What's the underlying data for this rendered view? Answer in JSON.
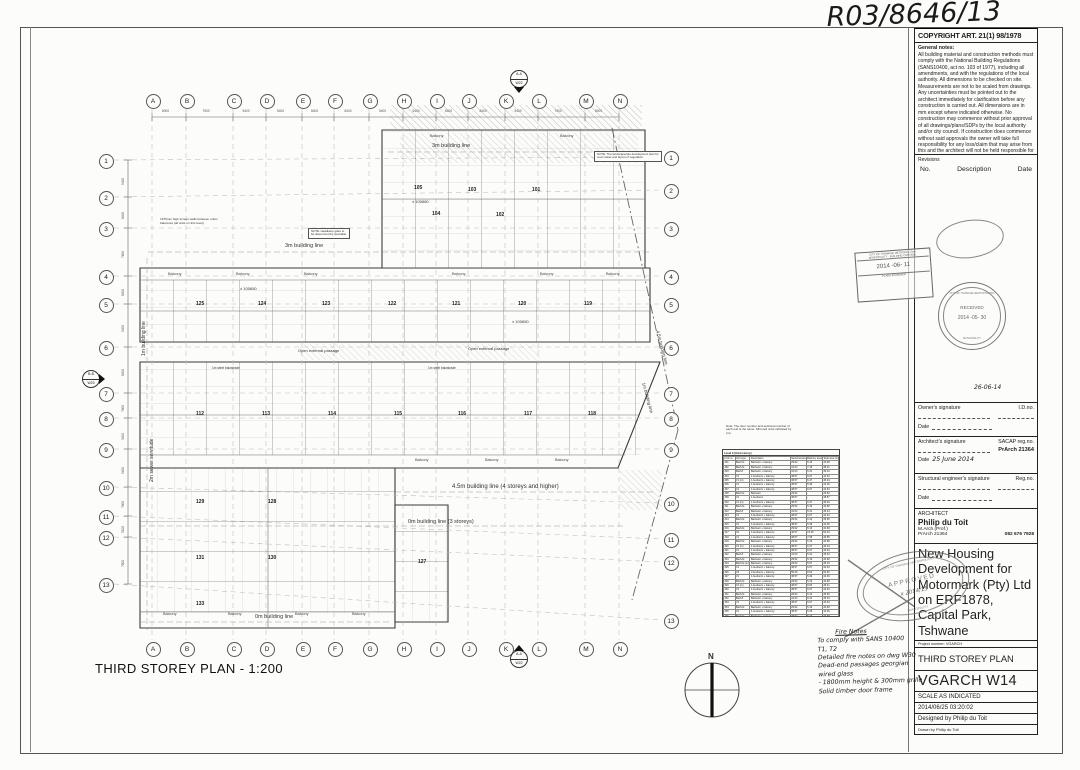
{
  "annotations": {
    "drawing_number": "R03/8646/13",
    "sig_date_main": "26-06-14",
    "approved_word": "APPROVED",
    "approved_note": "x 2014/15"
  },
  "title_block": {
    "copyright": "COPYRIGHT ART. 21(1) 98/1978",
    "general_notes_title": "General notes:",
    "general_notes": "All building material and construction methods must comply with the National Building Regulations (SANS10400, act no. 103 of 1977), including all amendments, and with the regulations of the local authority. All dimensions to be checked on site. Measurements are not to be scaled from drawings. Any uncertainties must be pointed out to the architect immediately for clarification before any construction is carried out. All dimensions are in mm except where indicated otherwise. No construction may commence without prior approval of all drawings/plans/SDPs by the local authority and/or city council. If construction does commence without said approvals the owner will take full responsibility for any loss/claim that may arise from this and the architect will not be held responsible for any loss/claim.",
    "revisions_label": "Revisions",
    "rev_no": "No.",
    "rev_desc": "Description",
    "rev_date": "Date",
    "owner_label": "Owner's signature",
    "owner_id_label": "I.D.no.",
    "date_label": "Date",
    "arch_sig_label": "Architect's signature",
    "arch_reg_label": "SACAP reg.no.",
    "arch_reg_no": "PrArch 21364",
    "arch_sig_date": "25 June 2014",
    "eng_label": "Structural engineer's signature",
    "eng_reg_label": "Reg.no.",
    "architect_heading": "ARCHITECT",
    "architect_name": "Philip du Toit",
    "architect_qual": "M.Arch.(Prof.)",
    "architect_reg": "PrArch 21364",
    "architect_phone": "082 676 7928",
    "project_title": "New Housing Development for Motormark (Pty) Ltd on ERF1878, Capital Park, Tshwane",
    "project_number": "Project number:  VGARCH",
    "sheet_title": "THIRD STOREY PLAN",
    "drawing_code": "VGARCH W14",
    "scale": "SCALE AS INDICATED",
    "datetime": "2014/06/25 03:20:02",
    "designed_by": "Designed by Philip du Toit",
    "drawn_by": "Drawn by Philip du Toit"
  },
  "stamps": {
    "received_word": "RECEIVED",
    "received_date": "2014 -05- 30",
    "received_ring_top": "CITY OF TSHWANE METROPOLITAN",
    "received_ring_bottom": "MUNICIPALITY",
    "rect_line1": "CITY OF TSHWANE METROPOLITAN",
    "rect_line2": "MUNICIPALITY · BUILDING CONTROL",
    "rect_date": "2014 -06- 11",
    "rect_line3": "PLANS EXAMINER",
    "approved_ring_top": "CITY OF TSHWANE METROPOLITAN",
    "approved_ring_bottom": "MUNICIPALITY"
  },
  "plan": {
    "title": "THIRD STOREY PLAN - 1:200",
    "north_label": "N",
    "balcony_label": "Balcony",
    "grid_top_y": 100,
    "grid_bottom_y": 648,
    "grid_letters": [
      {
        "l": "A",
        "x": 152
      },
      {
        "l": "B",
        "x": 186
      },
      {
        "l": "C",
        "x": 233
      },
      {
        "l": "D",
        "x": 266
      },
      {
        "l": "E",
        "x": 302
      },
      {
        "l": "F",
        "x": 334
      },
      {
        "l": "G",
        "x": 369
      },
      {
        "l": "H",
        "x": 403
      },
      {
        "l": "I",
        "x": 436
      },
      {
        "l": "J",
        "x": 468
      },
      {
        "l": "K",
        "x": 505
      },
      {
        "l": "L",
        "x": 538
      },
      {
        "l": "M",
        "x": 585
      },
      {
        "l": "N",
        "x": 619
      }
    ],
    "top_dims": [
      "8000",
      "7500",
      "5400",
      "5400",
      "8400",
      "8400",
      "5400",
      "5400",
      "8400",
      "8400",
      "5400",
      "7000",
      "8400"
    ],
    "rows_left_x": 105,
    "rows_right_x": 670,
    "grid_rows": [
      {
        "n": "1",
        "y": 160,
        "yr": 157
      },
      {
        "n": "2",
        "y": 197,
        "yr": 190
      },
      {
        "n": "3",
        "y": 228,
        "yr": 228
      },
      {
        "n": "4",
        "y": 276,
        "yr": 276
      },
      {
        "n": "5",
        "y": 304,
        "yr": 304
      },
      {
        "n": "6",
        "y": 347,
        "yr": 347
      },
      {
        "n": "7",
        "y": 393,
        "yr": 393
      },
      {
        "n": "8",
        "y": 418,
        "yr": 418
      },
      {
        "n": "9",
        "y": 449,
        "yr": 449
      },
      {
        "n": "10",
        "y": 487,
        "yr": 503
      },
      {
        "n": "11",
        "y": 516,
        "yr": 539
      },
      {
        "n": "12",
        "y": 537,
        "yr": 562
      },
      {
        "n": "13",
        "y": 584,
        "yr": 620
      }
    ],
    "left_dims": [
      "9400",
      "8400",
      "7600",
      "8400",
      "5400",
      "8400",
      "7600",
      "3400",
      "9400",
      "7600",
      "5100",
      "7600"
    ],
    "section_top": {
      "a": "A-A",
      "b": "W22"
    },
    "section_bottom": {
      "a": "A-A",
      "b": "W22"
    },
    "section_left": {
      "a": "B-B",
      "b": "W23"
    },
    "labels": [
      {
        "t": "3m building line",
        "x": 285,
        "y": 243,
        "s": 5.5
      },
      {
        "t": "3m building line",
        "x": 432,
        "y": 143,
        "s": 5.5
      },
      {
        "t": "1m building line",
        "x": 142,
        "y": 356,
        "s": 5,
        "r": -90
      },
      {
        "t": "2m sewer servitude",
        "x": 150,
        "y": 482,
        "s": 5,
        "r": -90
      },
      {
        "t": "4.5m building line (4 storeys and higher)",
        "x": 452,
        "y": 484,
        "s": 6
      },
      {
        "t": "0m building line (3 storeys)",
        "x": 408,
        "y": 519,
        "s": 5.5
      },
      {
        "t": "0m building line",
        "x": 255,
        "y": 614,
        "s": 5.5
      },
      {
        "t": "1m building line",
        "x": 646,
        "y": 382,
        "s": 4.5,
        "r": 75
      },
      {
        "t": "4.5m building line",
        "x": 660,
        "y": 330,
        "s": 4.5,
        "r": 75
      },
      {
        "t": "Open external passage",
        "x": 298,
        "y": 349,
        "s": 4
      },
      {
        "t": "Open external passage",
        "x": 468,
        "y": 347,
        "s": 4
      },
      {
        "t": "1m steel balustrade",
        "x": 212,
        "y": 367,
        "s": 3.2
      },
      {
        "t": "1m steel balustrade",
        "x": 428,
        "y": 367,
        "s": 3.2
      },
      {
        "t": "± 100650",
        "x": 240,
        "y": 287,
        "s": 4
      },
      {
        "t": "± 100650",
        "x": 512,
        "y": 320,
        "s": 4
      },
      {
        "t": "± 100660",
        "x": 412,
        "y": 200,
        "s": 4
      },
      {
        "t": "1675mm high screen walls between units/ balconies (all units on this level)",
        "x": 160,
        "y": 218,
        "s": 3.1,
        "w": 58,
        "wrap": 1
      },
      {
        "t": "NOTE: The landscape/site development plan for court areas and layout of vegetation.",
        "x": 594,
        "y": 151,
        "s": 2.9,
        "w": 62,
        "wrap": 1,
        "bx": 1
      },
      {
        "t": "NOTE: Headlamp glare to be determined by specialist.",
        "x": 308,
        "y": 228,
        "s": 2.9,
        "w": 36,
        "wrap": 1,
        "bx": 1
      },
      {
        "t": "Note: The door number and sectional number of each unit is the same. Mirrored units indicated by (m).",
        "x": 726,
        "y": 425,
        "s": 3,
        "w": 66,
        "wrap": 1
      }
    ],
    "balconies": [
      [
        168,
        272
      ],
      [
        236,
        272
      ],
      [
        304,
        272
      ],
      [
        452,
        272
      ],
      [
        540,
        272
      ],
      [
        606,
        272
      ],
      [
        430,
        134
      ],
      [
        560,
        134
      ],
      [
        415,
        458
      ],
      [
        485,
        458
      ],
      [
        555,
        458
      ],
      [
        163,
        612
      ],
      [
        228,
        612
      ],
      [
        295,
        612
      ],
      [
        352,
        612
      ]
    ],
    "unit_numbers": [
      [
        "105",
        414,
        186
      ],
      [
        "104",
        432,
        212
      ],
      [
        "103",
        468,
        188
      ],
      [
        "102",
        496,
        213
      ],
      [
        "101",
        532,
        188
      ],
      [
        "125",
        196,
        302
      ],
      [
        "124",
        258,
        302
      ],
      [
        "123",
        322,
        302
      ],
      [
        "122",
        388,
        302
      ],
      [
        "121",
        452,
        302
      ],
      [
        "120",
        518,
        302
      ],
      [
        "119",
        584,
        302
      ],
      [
        "112",
        196,
        412
      ],
      [
        "113",
        262,
        412
      ],
      [
        "114",
        328,
        412
      ],
      [
        "115",
        394,
        412
      ],
      [
        "116",
        458,
        412
      ],
      [
        "117",
        524,
        412
      ],
      [
        "118",
        588,
        412
      ],
      [
        "129",
        196,
        500
      ],
      [
        "128",
        268,
        500
      ],
      [
        "131",
        196,
        556
      ],
      [
        "130",
        268,
        556
      ],
      [
        "133",
        196,
        602
      ],
      [
        "127",
        418,
        560
      ]
    ]
  },
  "schedule": {
    "title": "Level 3 (third storey)",
    "headers": [
      "Unit no.",
      "Unit type",
      "Description",
      "Sectional area (m²)",
      "Balcony area (m²)",
      "Total area (m²)"
    ],
    "rows": [
      [
        "301",
        "Bach/st",
        "Bachelor + balcony",
        "29.52",
        "5.16",
        "34.68"
      ],
      [
        "302",
        "Bach/st",
        "Bachelor + balcony",
        "31.03",
        "7.18",
        "38.21"
      ],
      [
        "303",
        "Bach/f",
        "Bachelor + balcony",
        "31.03",
        "5.31",
        "36.34"
      ],
      [
        "304",
        "V1",
        "1-bedroom + balcony",
        "38.57",
        "6.07",
        "44.64"
      ],
      [
        "305",
        "V1 (m)",
        "1-bedroom + balcony",
        "38.57",
        "6.47",
        "45.04"
      ],
      [
        "306",
        "V1",
        "1-bedroom + balcony",
        "38.57",
        "5.49",
        "44.06"
      ],
      [
        "307",
        "V1",
        "1-bedroom + balcony",
        "38.57",
        "6.07",
        "44.64"
      ],
      [
        "308",
        "Bach/st",
        "Bachelor",
        "29.52",
        "-",
        "29.52"
      ],
      [
        "309",
        "V1",
        "1-bedroom",
        "38.57",
        "-",
        "38.57"
      ],
      [
        "310",
        "V1 (m)",
        "1-bedroom + balcony",
        "38.57",
        "6.47",
        "45.04"
      ],
      [
        "311",
        "Bach/st",
        "Bachelor + balcony",
        "29.52",
        "5.16",
        "34.68"
      ],
      [
        "312",
        "Bach/f",
        "Bachelor + balcony",
        "31.03",
        "5.31",
        "36.34"
      ],
      [
        "313",
        "V1",
        "1-bedroom + balcony",
        "38.57",
        "6.07",
        "44.64"
      ],
      [
        "314",
        "Bach/st",
        "Bachelor + balcony",
        "29.52",
        "6.14",
        "35.66"
      ],
      [
        "315",
        "V1",
        "1-bedroom + balcony",
        "38.57",
        "5.49",
        "44.06"
      ],
      [
        "316",
        "Bach/st",
        "Bachelor + balcony",
        "29.52",
        "5.16",
        "34.68"
      ],
      [
        "317",
        "V2",
        "1-bedroom + balcony",
        "40.57",
        "13.46",
        "54.03"
      ],
      [
        "318",
        "V1",
        "1-bedroom + balcony",
        "38.57",
        "7.98",
        "46.55"
      ],
      [
        "319",
        "Bach/st",
        "Bachelor + balcony",
        "29.52",
        "5.16",
        "34.68"
      ],
      [
        "320",
        "V1 (m)",
        "1-bedroom + balcony",
        "38.57",
        "6.47",
        "45.04"
      ],
      [
        "321",
        "V1",
        "1-bedroom + balcony",
        "38.57",
        "6.07",
        "44.64"
      ],
      [
        "322",
        "Bach/f",
        "Bachelor + balcony",
        "31.03",
        "5.31",
        "36.34"
      ],
      [
        "323",
        "Bach/st",
        "Bachelor + balcony",
        "29.52",
        "5.16",
        "34.68"
      ],
      [
        "324",
        "Bach/st (m)",
        "Bachelor + balcony",
        "29.52",
        "5.67",
        "35.19"
      ],
      [
        "325",
        "V1",
        "1-bedroom + balcony",
        "38.57",
        "6.07",
        "44.64"
      ],
      [
        "326",
        "V3",
        "2-bedroom + balcony",
        "55.26",
        "8.64",
        "63.90"
      ],
      [
        "327",
        "V1",
        "1-bedroom + balcony",
        "38.57",
        "5.49",
        "44.06"
      ],
      [
        "328",
        "Bach/st",
        "Bachelor + balcony",
        "29.52",
        "5.16",
        "34.68"
      ],
      [
        "329",
        "V1 (m)",
        "1-bedroom + balcony",
        "38.57",
        "6.84",
        "45.41"
      ],
      [
        "330",
        "V1",
        "1-bedroom + balcony",
        "38.57",
        "6.07",
        "44.64"
      ],
      [
        "331",
        "Bach/st",
        "Bachelor + balcony",
        "29.52",
        "6.14",
        "35.66"
      ],
      [
        "332",
        "Bach/f",
        "Bachelor + balcony",
        "31.03",
        "5.31",
        "36.34"
      ],
      [
        "333",
        "V1",
        "1-bedroom + balcony",
        "38.57",
        "6.07",
        "44.64"
      ],
      [
        "334",
        "Bach/st",
        "Bachelor + balcony",
        "29.52",
        "5.16",
        "34.68"
      ],
      [
        "335",
        "V1",
        "1-bedroom + balcony",
        "38.57",
        "5.49",
        "44.06"
      ],
      [
        "336",
        "Bach/st",
        "Bachelor + balcony",
        "29.52",
        "5.16",
        "34.68"
      ],
      [
        "337",
        "V2",
        "1-bedroom + balcony",
        "40.57",
        "13.46",
        "54.03"
      ],
      [
        "338",
        "V1",
        "1-bedroom + balcony",
        "38.57",
        "7.98",
        "46.55"
      ],
      [
        "339",
        "Bach/st",
        "Bachelor + balcony",
        "29.52",
        "5.16",
        "34.68"
      ],
      [
        "340",
        "V1",
        "1-bedroom + balcony",
        "38.57",
        "6.07",
        "44.64"
      ],
      [
        "341",
        "Bach/st",
        "Bachelor + balcony",
        "29.52",
        "6.14",
        "35.66"
      ],
      [
        "342",
        "Bach/f",
        "Bachelor + balcony",
        "31.03",
        "5.31",
        "36.34"
      ],
      [
        "343",
        "V1",
        "1-bedroom + balcony",
        "38.57",
        "6.07",
        "44.64"
      ],
      [
        "344",
        "V1 (m)",
        "1-bedroom + balcony",
        "38.57",
        "6.47",
        "45.04"
      ]
    ],
    "footer": "Note: Balconies are not counted"
  },
  "fire_notes": [
    "Fire Notes",
    "To comply with SANS 10400",
    "T1, T2",
    "Detailed fire notes on dwg W30",
    "Dead-end passages  georgian wired glass",
    "-  1800mm height & 300mm grille",
    "Solid timber door frame"
  ]
}
